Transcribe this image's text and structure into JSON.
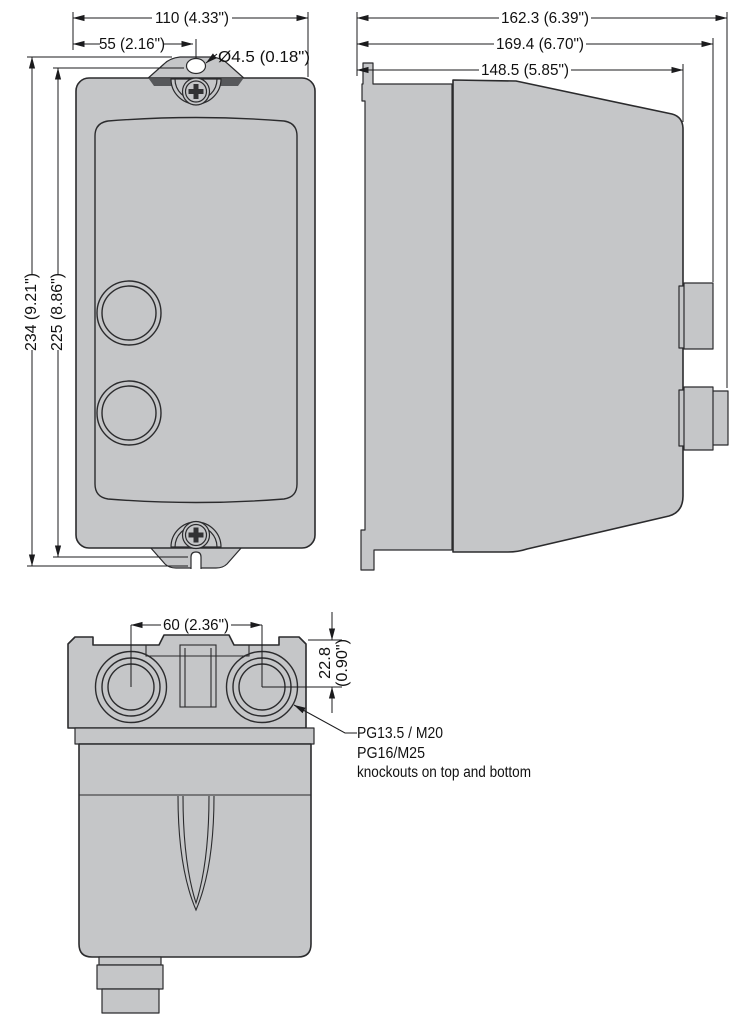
{
  "views": {
    "front": {
      "dim_overall_width": "110 (4.33\")",
      "dim_hole_center_offset": "55 (2.16\")",
      "dim_mounting_hole_diameter": "Ø4.5 (0.18\")",
      "dim_overall_height": "234 (9.21\")",
      "dim_mounting_hole_spacing": "225 (8.86\")"
    },
    "side": {
      "dim_depth_overall": "162.3 (6.39\")",
      "dim_depth_max": "169.4 (6.70\")",
      "dim_depth_body": "148.5 (5.85\")"
    },
    "bottom": {
      "dim_knockout_spacing": "60 (2.36\")",
      "dim_knockout_offset_mm": "22.8",
      "dim_knockout_offset_in": "(0.90\")",
      "note_line1": "PG13.5 / M20",
      "note_line2": "PG16/M25",
      "note_line3": "knockouts on top and bottom"
    }
  },
  "colors": {
    "body_fill": "#c5c6c8",
    "outline": "#2b2b2d",
    "shadow_accent": "#57585b",
    "background": "#ffffff"
  }
}
